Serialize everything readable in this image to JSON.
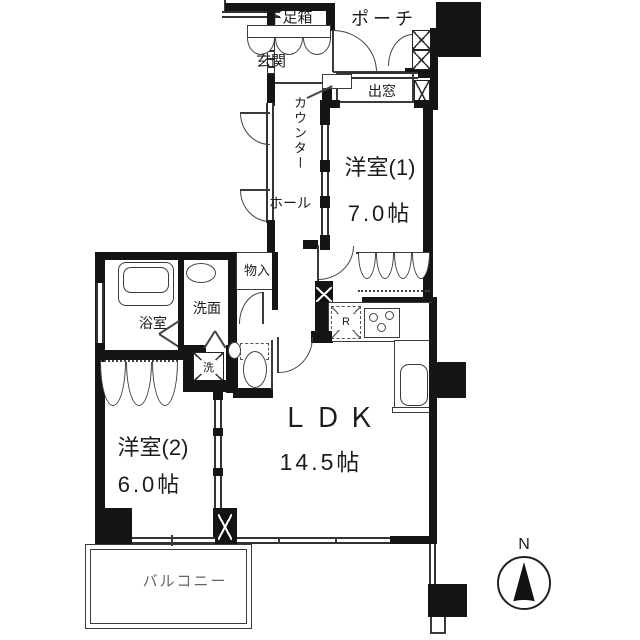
{
  "labels": {
    "shoe_box": "下足箱",
    "porch": "ポーチ",
    "genkan": "玄関",
    "counter": "カウンター",
    "bay_window": "出窓",
    "room1_name": "洋室(1)",
    "room1_size": "7.0帖",
    "hall": "ホール",
    "storage": "物入",
    "washroom": "洗面",
    "bathroom": "浴室",
    "laundry": "洗",
    "refrigerator": "R",
    "room2_name": "洋室(2)",
    "room2_size": "6.0帖",
    "ldk_name": "ＬＤＫ",
    "ldk_size": "14.5帖",
    "balcony": "バルコニー",
    "compass_north": "N"
  },
  "colors": {
    "wall": "#151515",
    "line": "#3a3a3a",
    "background": "#ffffff",
    "label": "#1c1c1c"
  }
}
